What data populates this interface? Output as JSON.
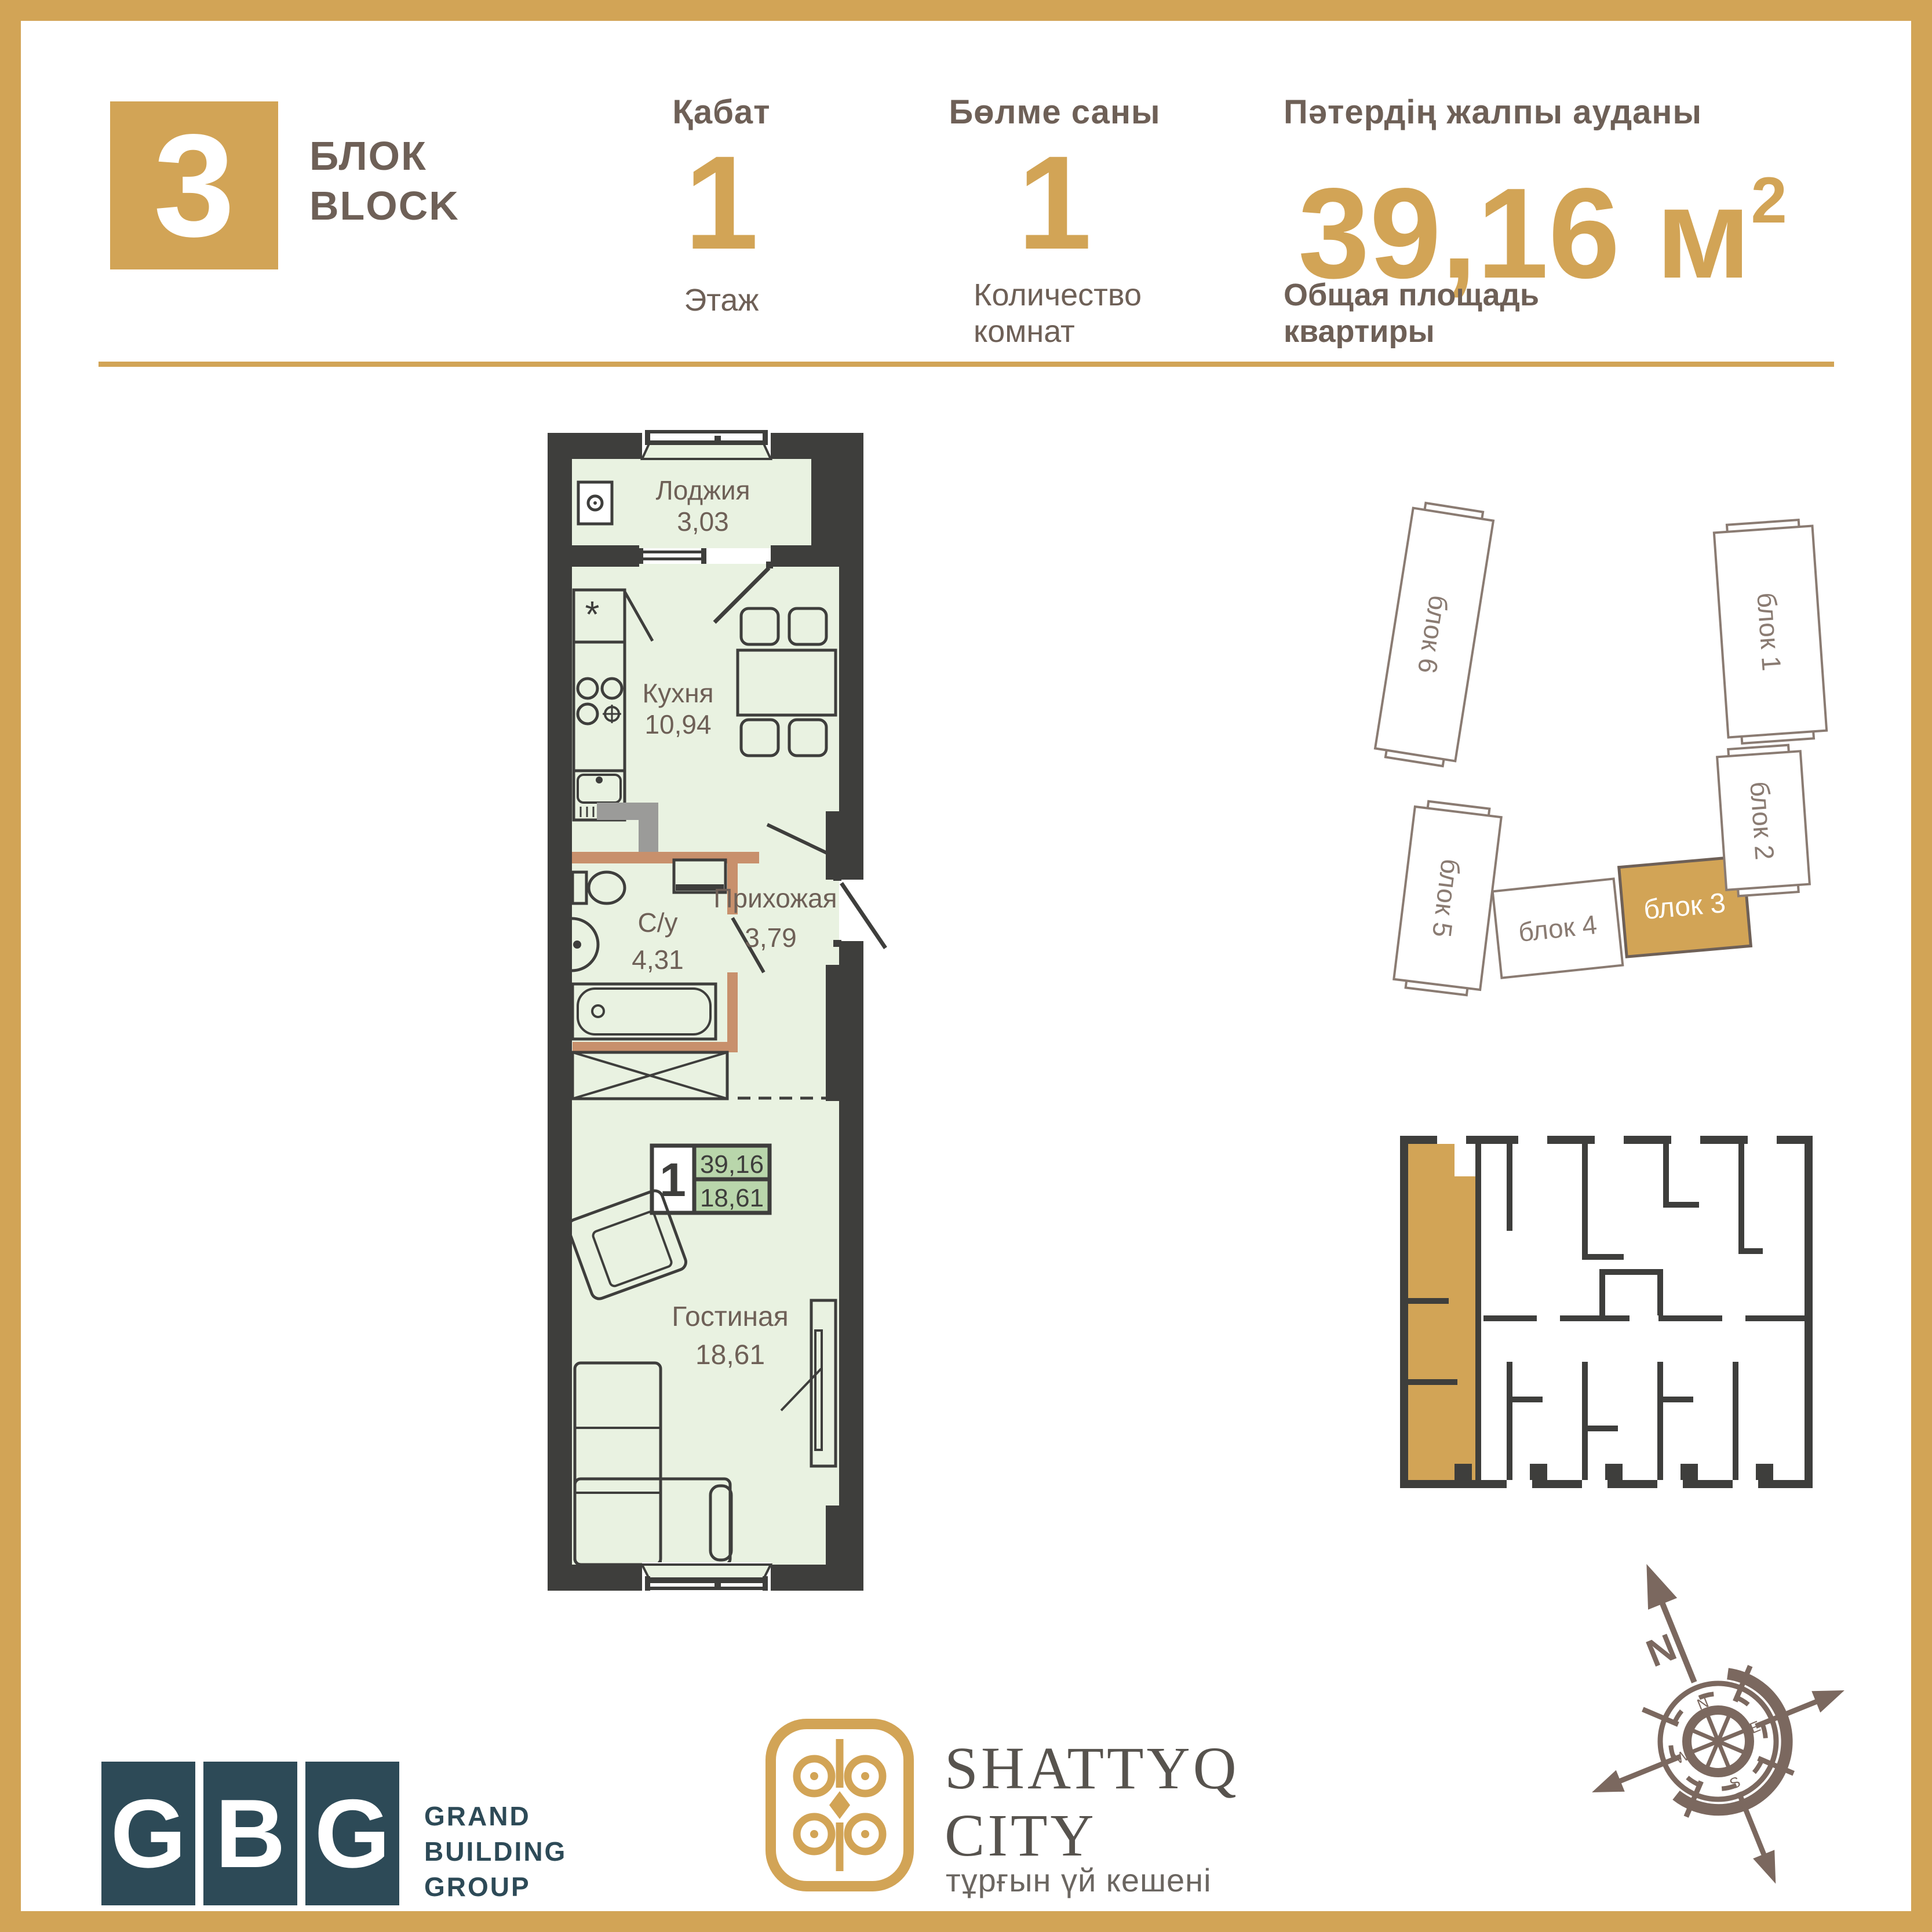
{
  "header": {
    "block_number": "3",
    "block_label_kk": "БЛОК",
    "block_label_en": "BLOCK",
    "floor": {
      "label_kk": "Қабат",
      "value": "1",
      "label_ru": "Этаж"
    },
    "rooms": {
      "label_kk": "Бөлме саны",
      "value": "1",
      "label_ru_line1": "Количество",
      "label_ru_line2": "комнат"
    },
    "area": {
      "label_kk": "Пәтердің жалпы ауданы",
      "value": "39,16",
      "unit": "м",
      "sup": "2",
      "label_ru_line1": "Общая площадь",
      "label_ru_line2": "квартиры"
    }
  },
  "floorplan": {
    "rooms": [
      {
        "name": "Лоджия",
        "area": "3,03"
      },
      {
        "name": "Кухня",
        "area": "10,94"
      },
      {
        "name": "С/у",
        "area": "4,31"
      },
      {
        "name": "Прихожая",
        "area": "3,79"
      },
      {
        "name": "Гостиная",
        "area": "18,61"
      }
    ],
    "fridge_symbol": "*",
    "badge": {
      "rooms": "1",
      "total_area": "39,16",
      "living_area": "18,61"
    }
  },
  "site_plan": {
    "blocks": [
      {
        "label": "блок 6",
        "highlighted": false
      },
      {
        "label": "блок 5",
        "highlighted": false
      },
      {
        "label": "блок 4",
        "highlighted": false
      },
      {
        "label": "блок 3",
        "highlighted": true
      },
      {
        "label": "блок 2",
        "highlighted": false
      },
      {
        "label": "блок 1",
        "highlighted": false
      }
    ]
  },
  "compass": {
    "north_label": "N",
    "ring_letters": [
      "N",
      "E",
      "S",
      "W"
    ]
  },
  "footer": {
    "gbg": {
      "letters": [
        "G",
        "B",
        "G"
      ],
      "name_lines": [
        "GRAND",
        "BUILDING",
        "GROUP"
      ]
    },
    "shattyq": {
      "title_line1": "SHATTYQ",
      "title_line2": "CITY",
      "subtitle": "тұрғын үй кешені"
    }
  },
  "colors": {
    "gold": "#d2a456",
    "text": "#6e6057",
    "wall": "#3e3e3c",
    "room": "#e9f2e1",
    "partition": "#c8906c",
    "badge_green": "#b9d6ab",
    "teal": "#2d4a57",
    "compass": "#7b685f"
  }
}
